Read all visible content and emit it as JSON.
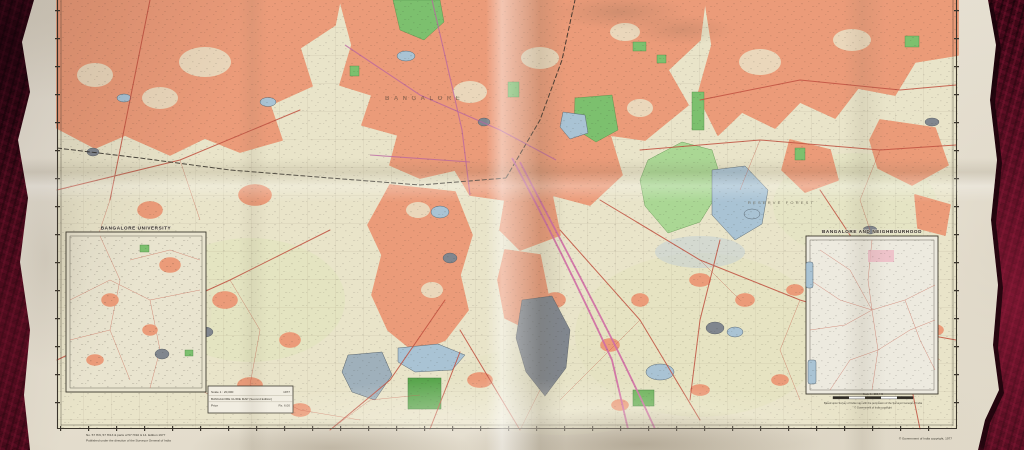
{
  "map": {
    "insets": {
      "university": {
        "title": "BANGALORE UNIVERSITY"
      },
      "environs": {
        "title": "BANGALORE AND NEIGHBOURHOOD",
        "scale_title": "Scale 1 : 253,440",
        "caption_line1": "Based upon Survey of India map with the permission of the Surveyor General of India",
        "caption_line2": "© Government of India copyright"
      }
    },
    "legend_box": {
      "line1_label": "Scale 1 : 20,000",
      "line1_value": "1977",
      "line2": "BANGALORE GUIDE MAP (Second Edition)",
      "line3_label": "Price",
      "line3_value": "Rs. 6.00"
    },
    "labels": {
      "city": "BANGALORE",
      "forest": "RESERVE FOREST"
    },
    "imprints": {
      "bottom_left_1": "No. 57 H/9, 57 H/13 & parts of 57 H/10 & 14. Edition 1977",
      "bottom_left_2": "Published under the direction of the Surveyor General of India",
      "bottom_right": "© Government of India copyright, 1977"
    },
    "colors": {
      "paper": "#e8e2d4",
      "map_base": "#e9e4c9",
      "urban": "#eb9b79",
      "park": "#7cc06e",
      "forest": "#aad794",
      "water": "#a9c3d4",
      "water_gray": "#9fb0bb",
      "tank": "#80868e",
      "road_red": "#c0503f",
      "road_magenta": "#cf6ba4",
      "rail": "#2e2a24",
      "carpet": "#3a0715",
      "ink": "#2e2a24"
    }
  }
}
